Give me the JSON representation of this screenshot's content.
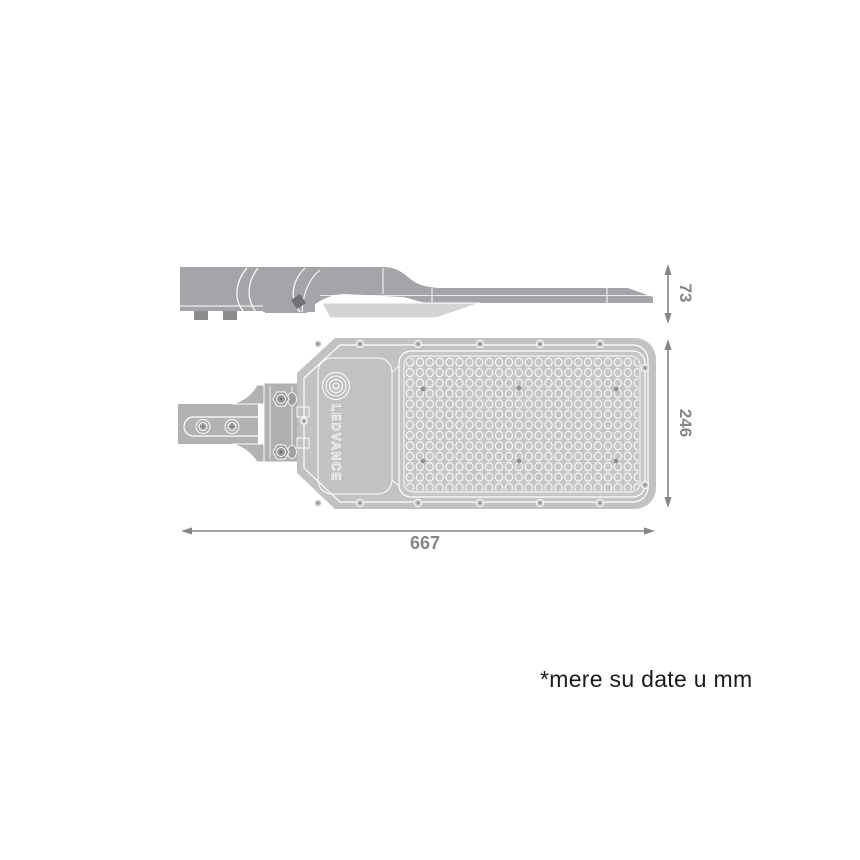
{
  "drawing": {
    "brand_label": "LEDVANCE",
    "note": "*mere su date u mm",
    "dimensions": {
      "height": "73",
      "width": "246",
      "length": "667"
    }
  },
  "colors": {
    "body_gray": "#c2c2c4",
    "led_panel_gray": "#c6c6c8",
    "side_view_gray": "#a4a5a8",
    "arm_gray": "#b2b2b5",
    "visor_light_gray": "#d4d4d6",
    "detail_line_white": "#ffffff",
    "dimension_gray": "#85868a",
    "note_text_black": "#1b1b1b"
  }
}
